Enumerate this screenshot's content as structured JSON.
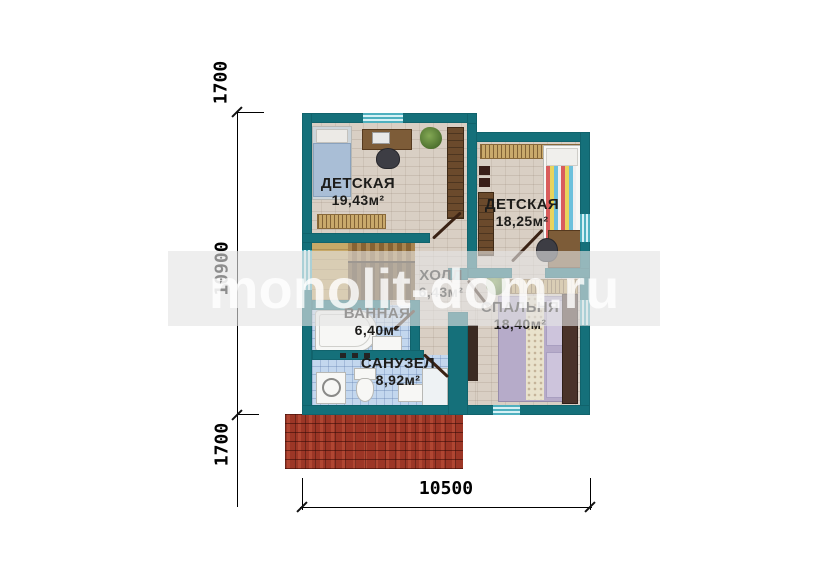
{
  "watermark": {
    "text": "monolit-dom.ru"
  },
  "dimensions": {
    "top_offset": "1700",
    "height": "10900",
    "bottom_offset": "1700",
    "width": "10500"
  },
  "rooms": [
    {
      "id": "kids-room-1",
      "name": "ДЕТСКАЯ",
      "area": "19,43м²",
      "furniture": [
        "bed",
        "desk",
        "chair",
        "plant",
        "wardrobe",
        "radiator"
      ]
    },
    {
      "id": "kids-room-2",
      "name": "ДЕТСКАЯ",
      "area": "18,25м²",
      "furniture": [
        "bed",
        "wardrobe",
        "speakers",
        "desk",
        "chair",
        "radiator"
      ]
    },
    {
      "id": "hall",
      "name": "ХОЛЛ",
      "area": "6,43м²",
      "furniture": [
        "staircase"
      ]
    },
    {
      "id": "bedroom",
      "name": "СПАЛЬНЯ",
      "area": "18,40м²",
      "furniture": [
        "double-bed",
        "dresser",
        "plant",
        "radiator"
      ]
    },
    {
      "id": "bathroom",
      "name": "ВАННАЯ",
      "area": "6,40м²",
      "furniture": [
        "bathtub",
        "sink"
      ]
    },
    {
      "id": "wc",
      "name": "САНУЗЕЛ",
      "area": "8,92м²",
      "furniture": [
        "washing-machine",
        "toilet",
        "sink",
        "shower"
      ]
    }
  ],
  "colors": {
    "wall": "#15707a",
    "floor": "#d9cfc4",
    "bathroom_tile": "#c3d7ee",
    "stairs_wood": "#b08a52",
    "roof_tile": "#9c3626",
    "watermark_band": "#e4e4e4",
    "dimension_lines": "#000000"
  }
}
